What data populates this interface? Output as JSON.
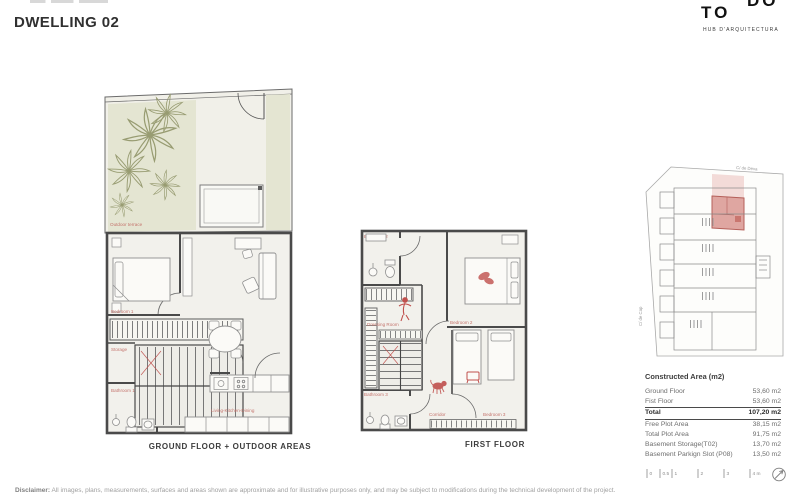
{
  "header": {
    "title": "DWELLING 02",
    "logo": {
      "line1": "DO",
      "line2": "TO",
      "tagline": "HUB D'ARQUITECTURA"
    }
  },
  "plans": {
    "ground": {
      "caption": "GROUND FLOOR + OUTDOOR AREAS",
      "rooms": {
        "terrace": "Outdoor terrace",
        "bedroom1": "Bedroom 1",
        "storage": "Storage",
        "bathroom1": "Bathroom 1",
        "living": "Living-Kitchen-Dining"
      }
    },
    "first": {
      "caption": "FIRST FLOOR",
      "rooms": {
        "bathroom2": "Bathroom 2",
        "dressing": "Dressing Room",
        "bedroom2": "Bedroom 2",
        "bathroom3": "Bathroom 3",
        "corridor": "Corridor",
        "bedroom3": "Bedroom 3"
      }
    }
  },
  "site_plan": {
    "street_top": "C/ de Déva",
    "street_left": "C/ de Cap"
  },
  "area_table": {
    "title": "Constructed Area (m2)",
    "rows": [
      {
        "label": "Ground Floor",
        "value": "53,60 m2"
      },
      {
        "label": "Fist Floor",
        "value": "53,60 m2"
      },
      {
        "label": "Total",
        "value": "107,20 m2"
      },
      {
        "label": "Free Plot Area",
        "value": "38,15 m2"
      },
      {
        "label": "Total Plot Area",
        "value": "91,75 m2"
      },
      {
        "label": "Basement Storage(T02)",
        "value": "13,70 m2"
      },
      {
        "label": "Basement Parkign Slot (P08)",
        "value": "13,50 m2"
      }
    ]
  },
  "scale_bar": {
    "ticks": [
      "0",
      "0.5",
      "1",
      "2",
      "3",
      "4 m"
    ]
  },
  "footer": {
    "disclaimer_lead": "Disclaimer:",
    "disclaimer_text": " All images, plans, measurements, surfaces and areas shown are approximate and for illustrative purposes only, and may be subject to modifications during the technical development of the project."
  },
  "colors": {
    "accent_red": "#c0504d",
    "room_label": "#c4736c",
    "terrace_green": "#e4e5d2",
    "highlight_pink": "#dfa6a1",
    "wall_gray": "#4a4a4a"
  }
}
